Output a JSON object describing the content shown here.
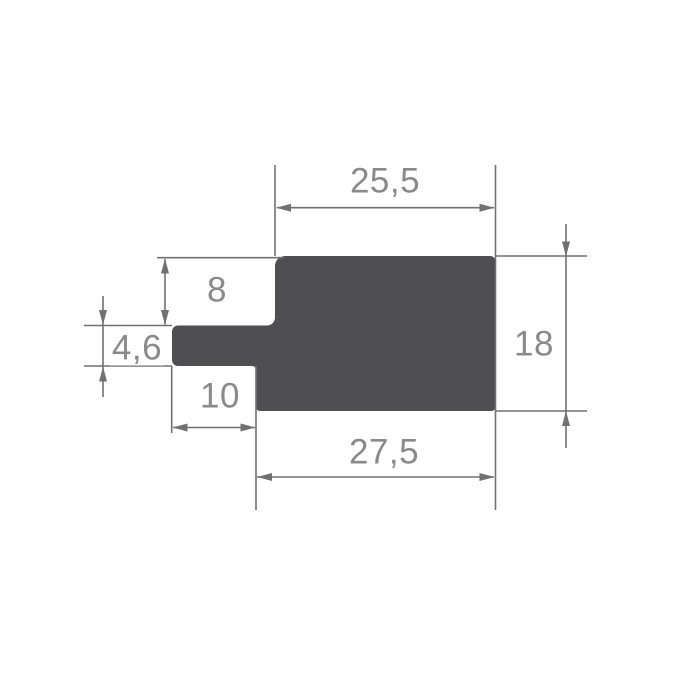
{
  "colors": {
    "shape": "#4f4f51",
    "line": "#717171",
    "text": "#8a8a8a",
    "background": "#ffffff"
  },
  "drawing": {
    "kind": "technical-profile-cross-section",
    "dimensions": {
      "top_width": "25,5",
      "left_upper_height": "8",
      "tab_thickness": "4,6",
      "tab_length": "10",
      "right_height": "18",
      "bottom_width": "27,5"
    }
  }
}
